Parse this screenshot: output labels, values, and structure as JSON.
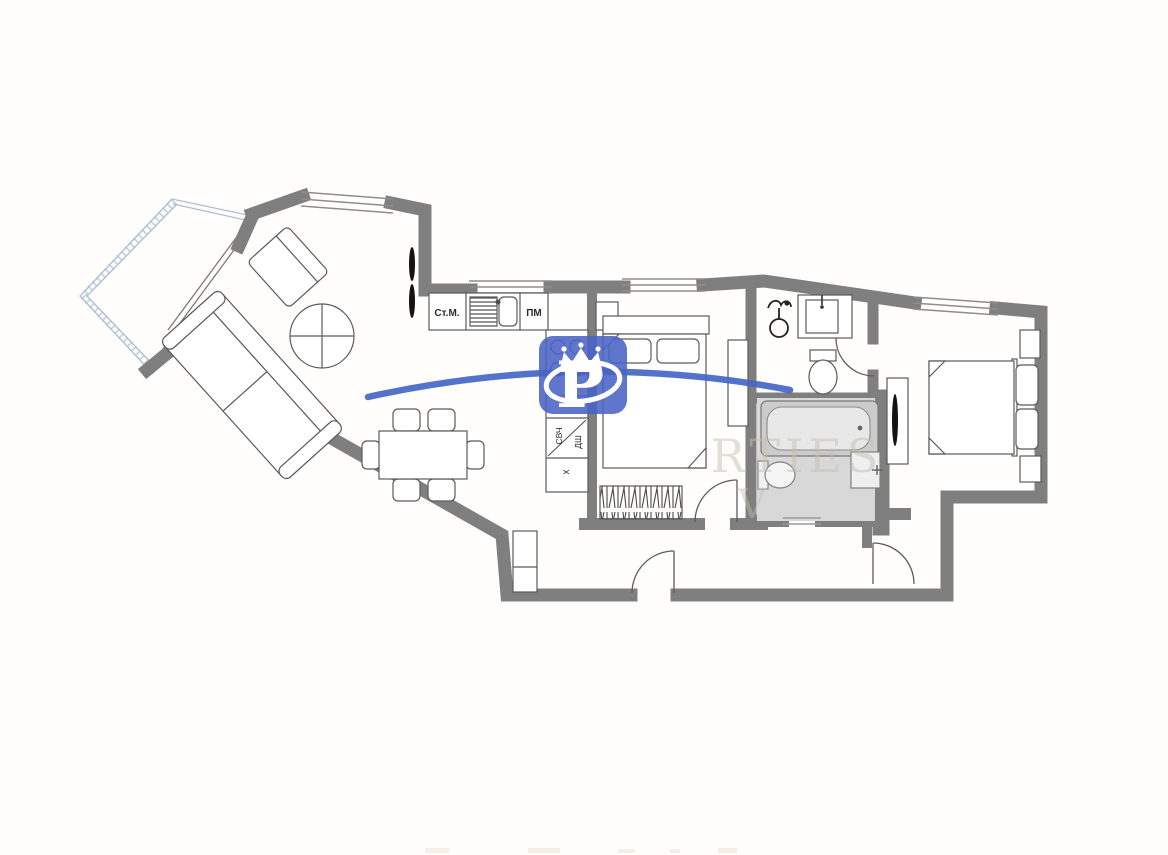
{
  "floorplan": {
    "kitchen_labels": {
      "washing_machine": "Ст.М.",
      "dishwasher": "ПМ",
      "microwave": "СВЧ",
      "oven": "ДШ",
      "fridge": "х"
    },
    "watermark": {
      "logo_letter": "P",
      "text_fragment_1": "RTIES",
      "text_fragment_2": "V"
    },
    "colors": {
      "wall": "#7f7f7f",
      "furniture_line": "#5a5a5a",
      "balcony_glazing": "#aebfd6",
      "bathroom_floor": "#d8d8d8",
      "logo_blue": "#4a63c6",
      "swoosh_blue": "#4466c4",
      "watermark_gray": "#c5bfae",
      "background": "#fffefd"
    }
  }
}
